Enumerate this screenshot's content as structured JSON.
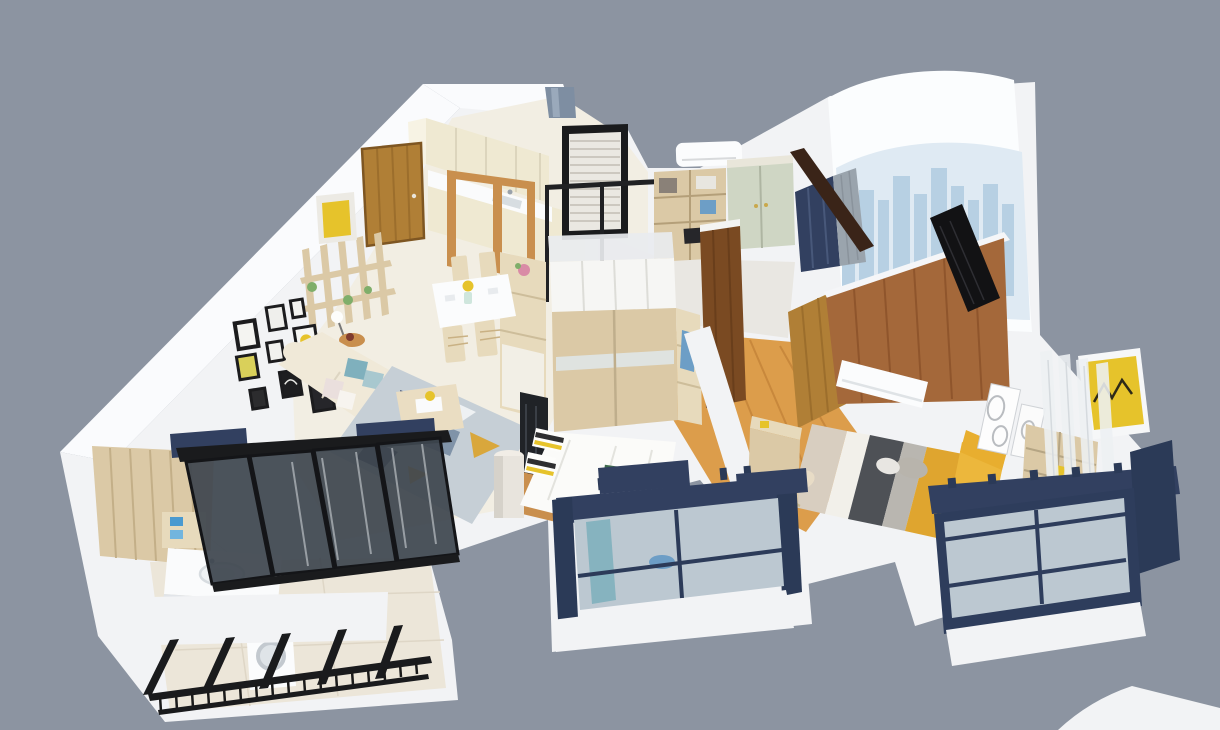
{
  "meta": {
    "title": "3D isometric apartment floor plan render (dollhouse cutaway view)",
    "background": "#8c94a1"
  },
  "palette": {
    "bg": "#8c94a1",
    "wall_white": "#f2f3f5",
    "wall_bright": "#fafbfd",
    "counter_white": "#fafbfc",
    "backdrop": "#fbfdfe",
    "skyline_light": "#dfeaf3",
    "skyline": "#b7d0e3",
    "floor_cream": "#f2eee3",
    "floor_gray": "#e9e7e2",
    "floor_tile": "#ece6d9",
    "wood_floor": "#dc9d4b",
    "cream_cabinet": "#efe9d2",
    "wood_mid": "#c98f4e",
    "door_oak": "#b07f36",
    "black": "#1a1b1d",
    "mesh": "#eae8e2",
    "wood_light": "#dbc9a6",
    "wood_pale": "#e7dabc",
    "sage": "#cfd6c4",
    "navy": "#324060",
    "navy_deep": "#2b3a57",
    "glass": "#bcc8d1",
    "glass_dark": "#3e464f",
    "white_goods": "#fbfcfd",
    "sofa_cream": "#f0e9d8",
    "duvet_white": "#fbfbf9",
    "rug_base": "#c6cfd6",
    "rug_navy": "#3c4a6b",
    "rug_slate": "#8093a8",
    "mustard": "#d9a73c",
    "brown_wall": "#a4683a",
    "wood_dark": "#7a4a22",
    "beam_dark": "#3a2418",
    "bed_beige": "#d8cec0",
    "bed_white": "#f2f0ea",
    "bed_gray_dark": "#4e5156",
    "bed_gray_light": "#b9b6b0",
    "bed_mustard": "#dfa52f",
    "yellow": "#e6c32b",
    "cushion_yellow": "#ecb73c",
    "teal": "#7fb0bd",
    "towel_blue": "#4a9ad0",
    "garment_blue": "#6d9ec6",
    "green": "#7fae6a",
    "pink": "#d98ba6",
    "sheer": "#edf0f2",
    "gray_curtain": "#9aa4ad"
  },
  "rooms": [
    {
      "id": "kitchen",
      "label": "Kitchen",
      "items": [
        "cream upper cabinets",
        "white counter with sink",
        "wood framed glass partition",
        "oak entry door",
        "small window"
      ]
    },
    {
      "id": "dining",
      "label": "Dining Area",
      "items": [
        "white dining table",
        "four wooden chairs",
        "yellow flowers in vase",
        "tall shelf cabinet with flowers"
      ]
    },
    {
      "id": "living",
      "label": "Living Room",
      "items": [
        "cream fabric sofa",
        "teal and blush pillows",
        "gallery wall of picture frames",
        "open wood shelving divider",
        "yellow display cube",
        "geometric area rug",
        "wood coffee table",
        "floor lamp",
        "round side table",
        "dark TV wall panel",
        "white column"
      ]
    },
    {
      "id": "entry_study",
      "label": "Entry / Study",
      "items": [
        "black mesh entry screen",
        "glass partition frame",
        "desk and bookshelf unit",
        "sage green wardrobe",
        "air conditioner",
        "navy accent wall",
        "gray curtain",
        "dark sloped beam"
      ]
    },
    {
      "id": "bedroom_2",
      "label": "Second Bedroom",
      "items": [
        "sliding-door wardrobe with glass top",
        "open shelf with blue garment",
        "white bed with black-white-yellow pillows",
        "green book on bed",
        "dark brown wardrobe door",
        "balcony with navy framed window",
        "teal curtain",
        "blue basin"
      ]
    },
    {
      "id": "hallway",
      "label": "Hallway",
      "items": [
        "honey wood flooring",
        "oak interior door",
        "white half wall"
      ]
    },
    {
      "id": "master_bedroom",
      "label": "Master Bedroom",
      "items": [
        "walnut plank headboard wall",
        "striped bed with mustard throw",
        "yellow headboard cushions",
        "wall air conditioner",
        "writing desk and chair",
        "leaning black TV panel",
        "oval art frames",
        "wood shelf unit",
        "yellow zigzag artwork",
        "sheer curtains",
        "navy bay window",
        "city skyline backdrop"
      ]
    },
    {
      "id": "bathroom_laundry",
      "label": "Bathroom / Laundry",
      "items": [
        "wood plank wall",
        "white vanity with sink",
        "blue towels",
        "black framed tinted sliding doors",
        "navy curtain pelmets"
      ]
    },
    {
      "id": "laundry_balcony",
      "label": "Laundry Balcony",
      "items": [
        "washing machine",
        "black railing with balusters",
        "black window mullions",
        "tiled floor"
      ]
    }
  ]
}
